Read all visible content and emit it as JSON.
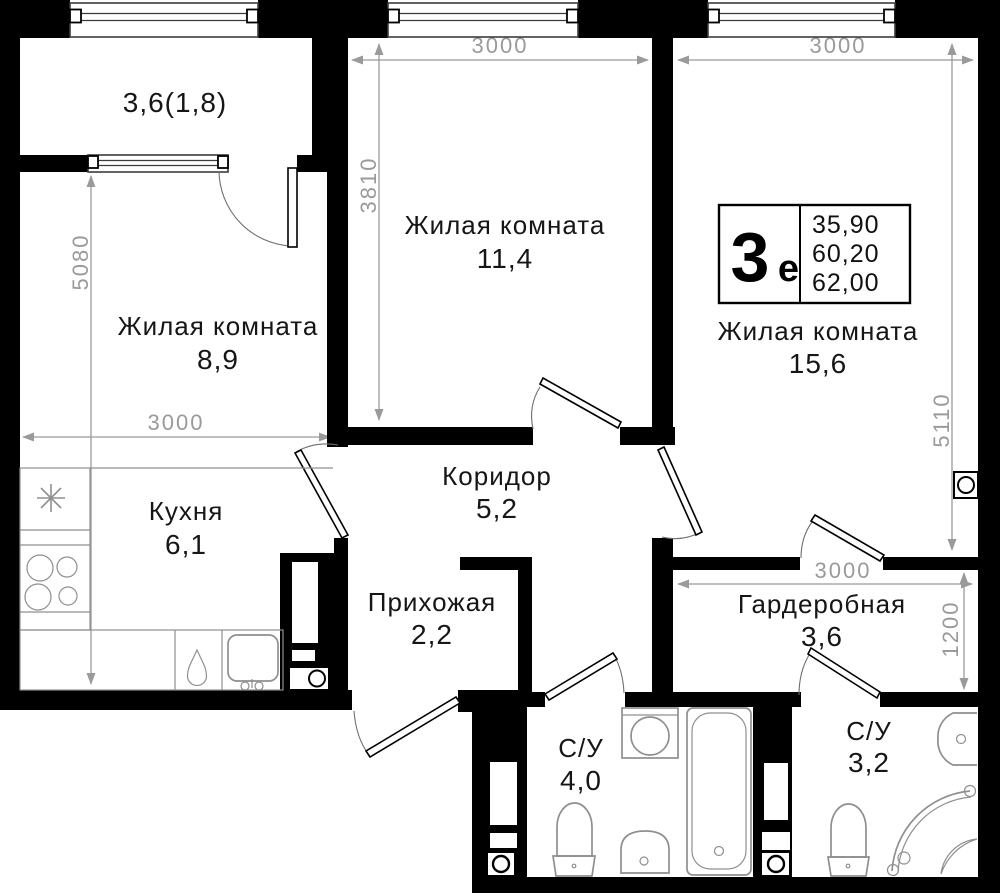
{
  "labels": {
    "balcony": {
      "area": "3,6(1,8)"
    },
    "living_mid": {
      "name": "Жилая комната",
      "area": "11,4"
    },
    "living_left": {
      "name": "Жилая комната",
      "area": "8,9"
    },
    "living_right": {
      "name": "Жилая комната",
      "area": "15,6"
    },
    "kitchen": {
      "name": "Кухня",
      "area": "6,1"
    },
    "corridor": {
      "name": "Коридор",
      "area": "5,2"
    },
    "hallway": {
      "name": "Прихожая",
      "area": "2,2"
    },
    "wardrobe": {
      "name": "Гардеробная",
      "area": "3,6"
    },
    "bathroom_main": {
      "name": "С/У",
      "area": "4,0"
    },
    "bathroom_second": {
      "name": "С/У",
      "area": "3,2"
    }
  },
  "unit_badge": {
    "layout_type": "3е",
    "layout_number": "3",
    "layout_suffix": "е",
    "area_rows": [
      "35,90",
      "60,20",
      "62,00"
    ]
  },
  "dimensions": {
    "living_mid_width": "3000",
    "living_right_width": "3000",
    "living_mid_depth": "3810",
    "left_side_depth": "5080",
    "living_left_width": "3000",
    "living_right_depth": "5110",
    "wardrobe_width": "3000",
    "wardrobe_depth": "1200"
  },
  "colors": {
    "wall": "#000000",
    "dimension": "#9a9a9a",
    "fixture": "#8f8f8f",
    "background": "#ffffff"
  }
}
